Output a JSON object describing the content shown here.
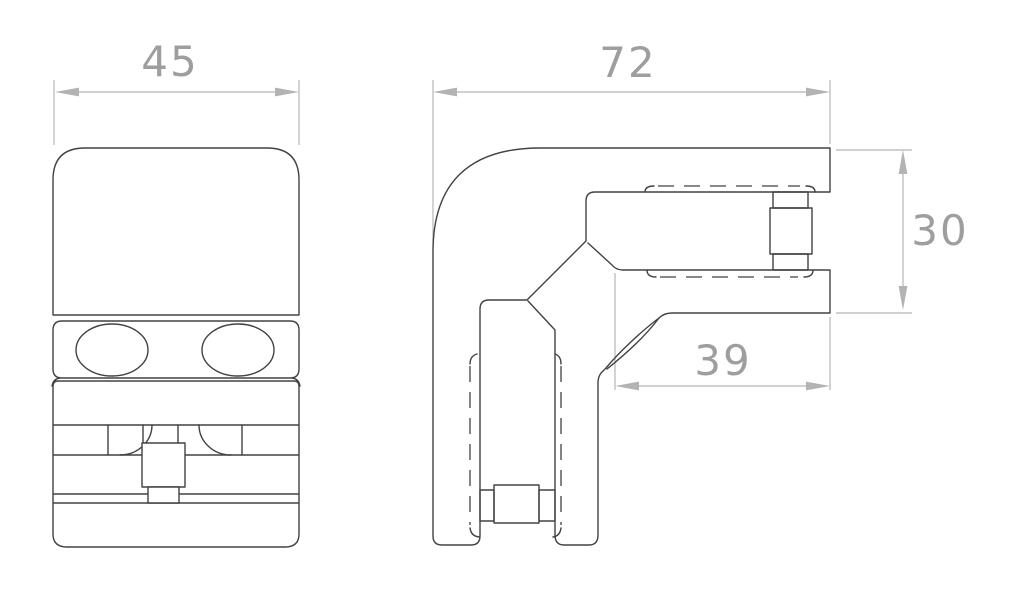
{
  "dimensions": {
    "front_width": "45",
    "side_width": "72",
    "side_height": "30",
    "side_arm": "39"
  },
  "colors": {
    "outline": "#424242",
    "dimline": "#b3b3b3",
    "dimtext": "#9e9e9e",
    "background": "#ffffff"
  }
}
